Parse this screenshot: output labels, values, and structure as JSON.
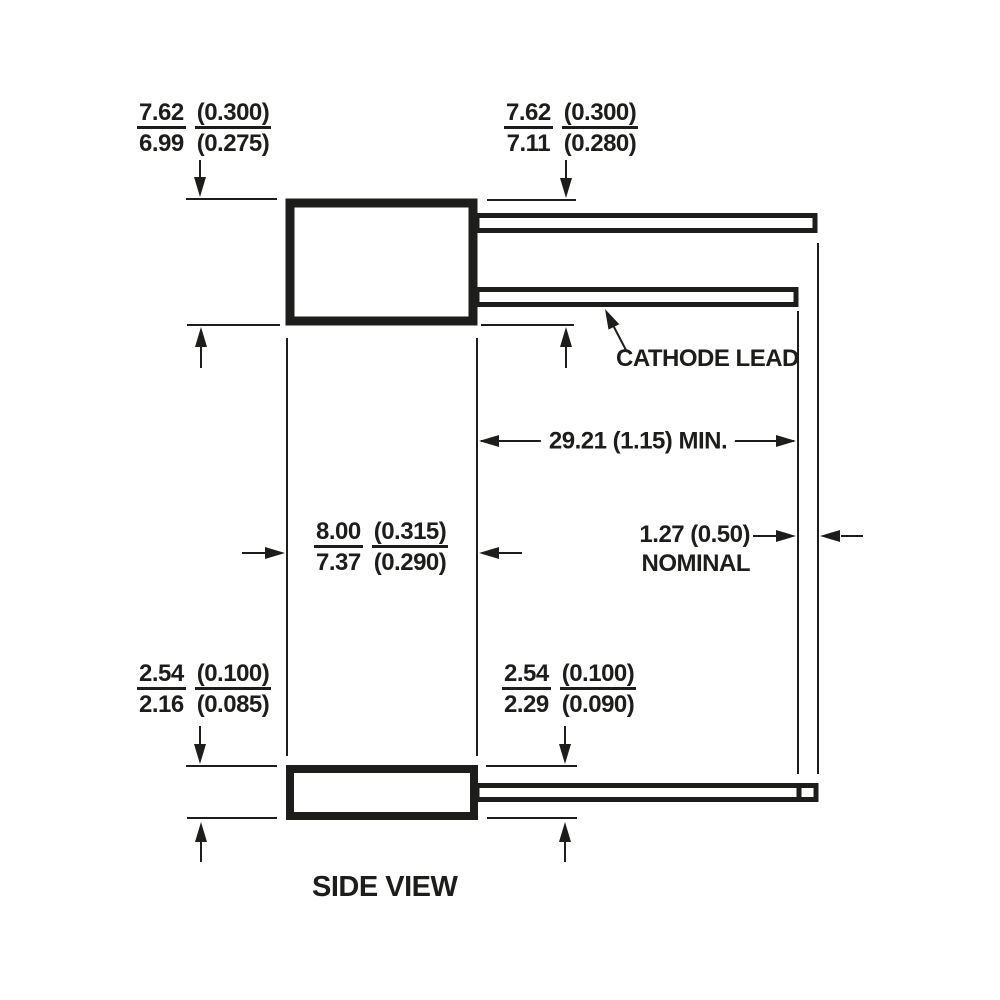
{
  "diagram": {
    "view_label": "SIDE VIEW",
    "callout_cathode": "CATHODE LEAD",
    "dim_body_height_left": {
      "mm_top": "7.62",
      "mm_bot": "6.99",
      "in_top": "(0.300)",
      "in_bot": "(0.275)"
    },
    "dim_body_height_right": {
      "mm_top": "7.62",
      "mm_bot": "7.11",
      "in_top": "(0.300)",
      "in_bot": "(0.280)"
    },
    "dim_body_width": {
      "mm_top": "8.00",
      "mm_bot": "7.37",
      "in_top": "(0.315)",
      "in_bot": "(0.290)"
    },
    "dim_lead_length": "29.21 (1.15) MIN.",
    "dim_lead_offset_value": "1.27 (0.50)",
    "dim_lead_offset_qualifier": "NOMINAL",
    "dim_base_height_left": {
      "mm_top": "2.54",
      "mm_bot": "2.16",
      "in_top": "(0.100)",
      "in_bot": "(0.085)"
    },
    "dim_base_height_right": {
      "mm_top": "2.54",
      "mm_bot": "2.29",
      "in_top": "(0.100)",
      "in_bot": "(0.090)"
    }
  },
  "colors": {
    "ink": "#1d1d1b",
    "background": "#ffffff"
  }
}
